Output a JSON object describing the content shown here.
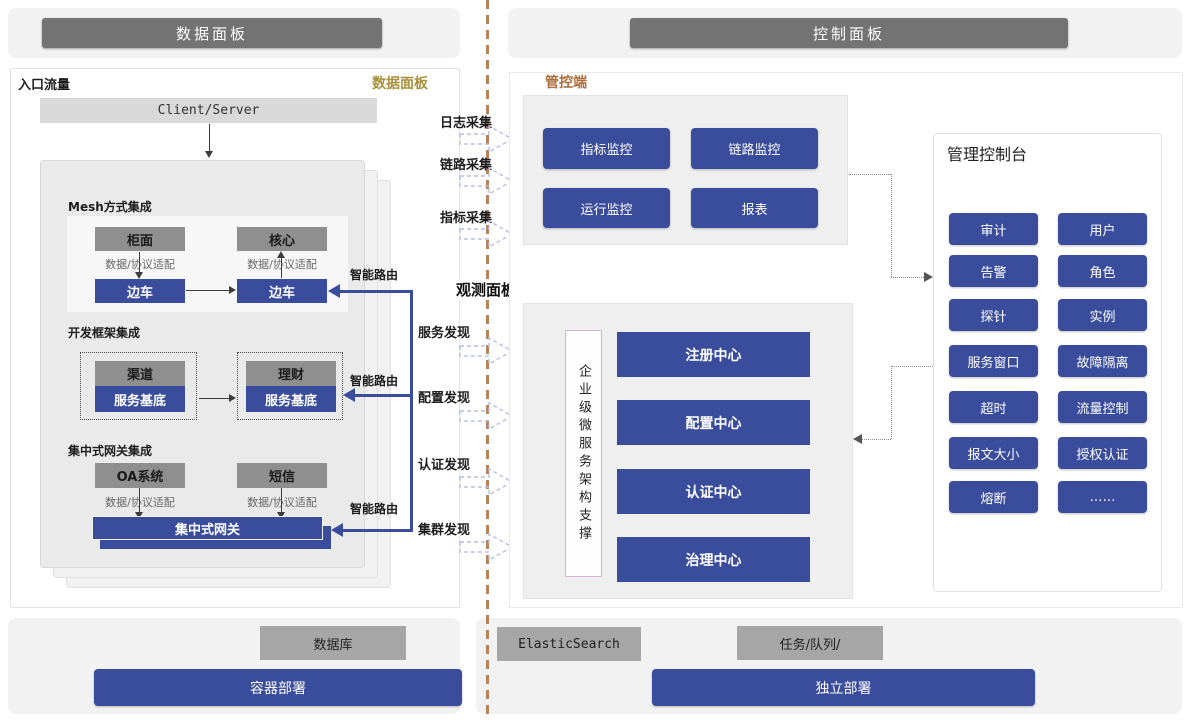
{
  "colors": {
    "accent_blue": "#3a4d9c",
    "dark_header": "#737373",
    "gray_node": "#8f8f8f",
    "gray_node_light": "#a6a6a6",
    "panel_fill": "#efefef",
    "gold_label": "#a8913c",
    "orange_label": "#ad6d3c",
    "divider": "#b5825a",
    "dashed_arrow": "#b6bee6"
  },
  "header": {
    "left": "数据面板",
    "right": "控制面板"
  },
  "data_panel": {
    "entry_label": "入口流量",
    "corner_label": "数据面板",
    "client_server": "Client/Server",
    "adapter_label": "数据/协议适配",
    "smart_route": "智能路由",
    "mesh": {
      "title": "Mesh方式集成",
      "front": "柜面",
      "core": "核心",
      "sidecar": "边车"
    },
    "framework": {
      "title": "开发框架集成",
      "channel": "渠道",
      "wealth": "理财",
      "base": "服务基底"
    },
    "gateway": {
      "title": "集中式网关集成",
      "oa": "OA系统",
      "sms": "短信",
      "gateway": "集中式网关"
    }
  },
  "middle": {
    "collect": [
      "日志采集",
      "链路采集",
      "指标采集"
    ],
    "observe": "观测面板",
    "discover": [
      "服务发现",
      "配置发现",
      "认证发现",
      "集群发现"
    ]
  },
  "control_panel": {
    "console_label": "管控端",
    "monitor_buttons": [
      "指标监控",
      "链路监控",
      "运行监控",
      "报表"
    ],
    "observe_support": "企业级微服务架构支撑",
    "centers": [
      "注册中心",
      "配置中心",
      "认证中心",
      "治理中心"
    ],
    "admin_console": {
      "title": "管理控制台",
      "buttons": [
        "审计",
        "用户",
        "告警",
        "角色",
        "探针",
        "实例",
        "服务窗口",
        "故障隔离",
        "超时",
        "流量控制",
        "报文大小",
        "授权认证",
        "熔断",
        "……"
      ]
    }
  },
  "bottom": {
    "database": "数据库",
    "container_deploy": "容器部署",
    "elastic": "ElasticSearch",
    "task_queue": "任务/队列/",
    "standalone_deploy": "独立部署"
  }
}
